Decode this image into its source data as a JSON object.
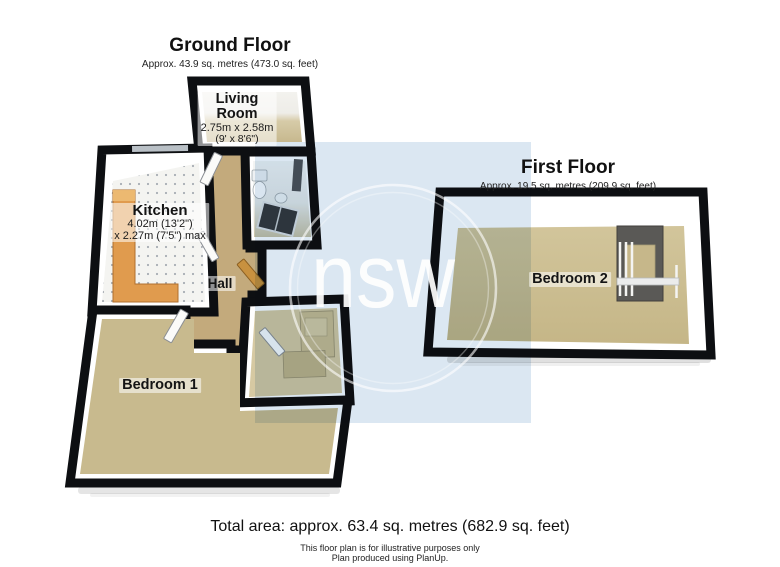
{
  "ground_floor": {
    "title": "Ground Floor",
    "area_label": "Approx. 43.9 sq. metres (473.0 sq. feet)",
    "rooms": {
      "living_room": {
        "name": "Living Room",
        "dims_metric": "2.75m x 2.58m",
        "dims_imperial": "(9' x 8'6\")"
      },
      "kitchen": {
        "name": "Kitchen",
        "dims_metric": "4.02m (13'2\")",
        "dims_metric2": "x 2.27m (7'5\") max"
      },
      "hall": {
        "name": "Hall"
      },
      "bedroom_1": {
        "name": "Bedroom 1"
      }
    }
  },
  "first_floor": {
    "title": "First Floor",
    "area_label": "Approx. 19.5 sq. metres (209.9 sq. feet)",
    "rooms": {
      "bedroom_2": {
        "name": "Bedroom 2"
      }
    }
  },
  "footer": {
    "total_area": "Total area: approx. 63.4 sq. metres (682.9 sq. feet)",
    "disclaimer": "This floor plan is for illustrative purposes only",
    "credit": "Plan produced using PlanUp."
  },
  "watermark": {
    "text": "nsw",
    "square_color": "#dbe7f2"
  },
  "colors": {
    "wall": "#0d0f12",
    "bedroom_floor": "#c8ba8e",
    "hall_floor": "#c3aa7c",
    "storage_floor": "#d6c9a2",
    "kitchen_floor": "#f4f4f1",
    "counter_orange": "#e09b4e",
    "bathroom_tile": "#e8eae7",
    "front_door_wood": "#c8913f",
    "wardrobe_grey": "#5a5956",
    "watermark_blue": "#dbe7f2"
  }
}
